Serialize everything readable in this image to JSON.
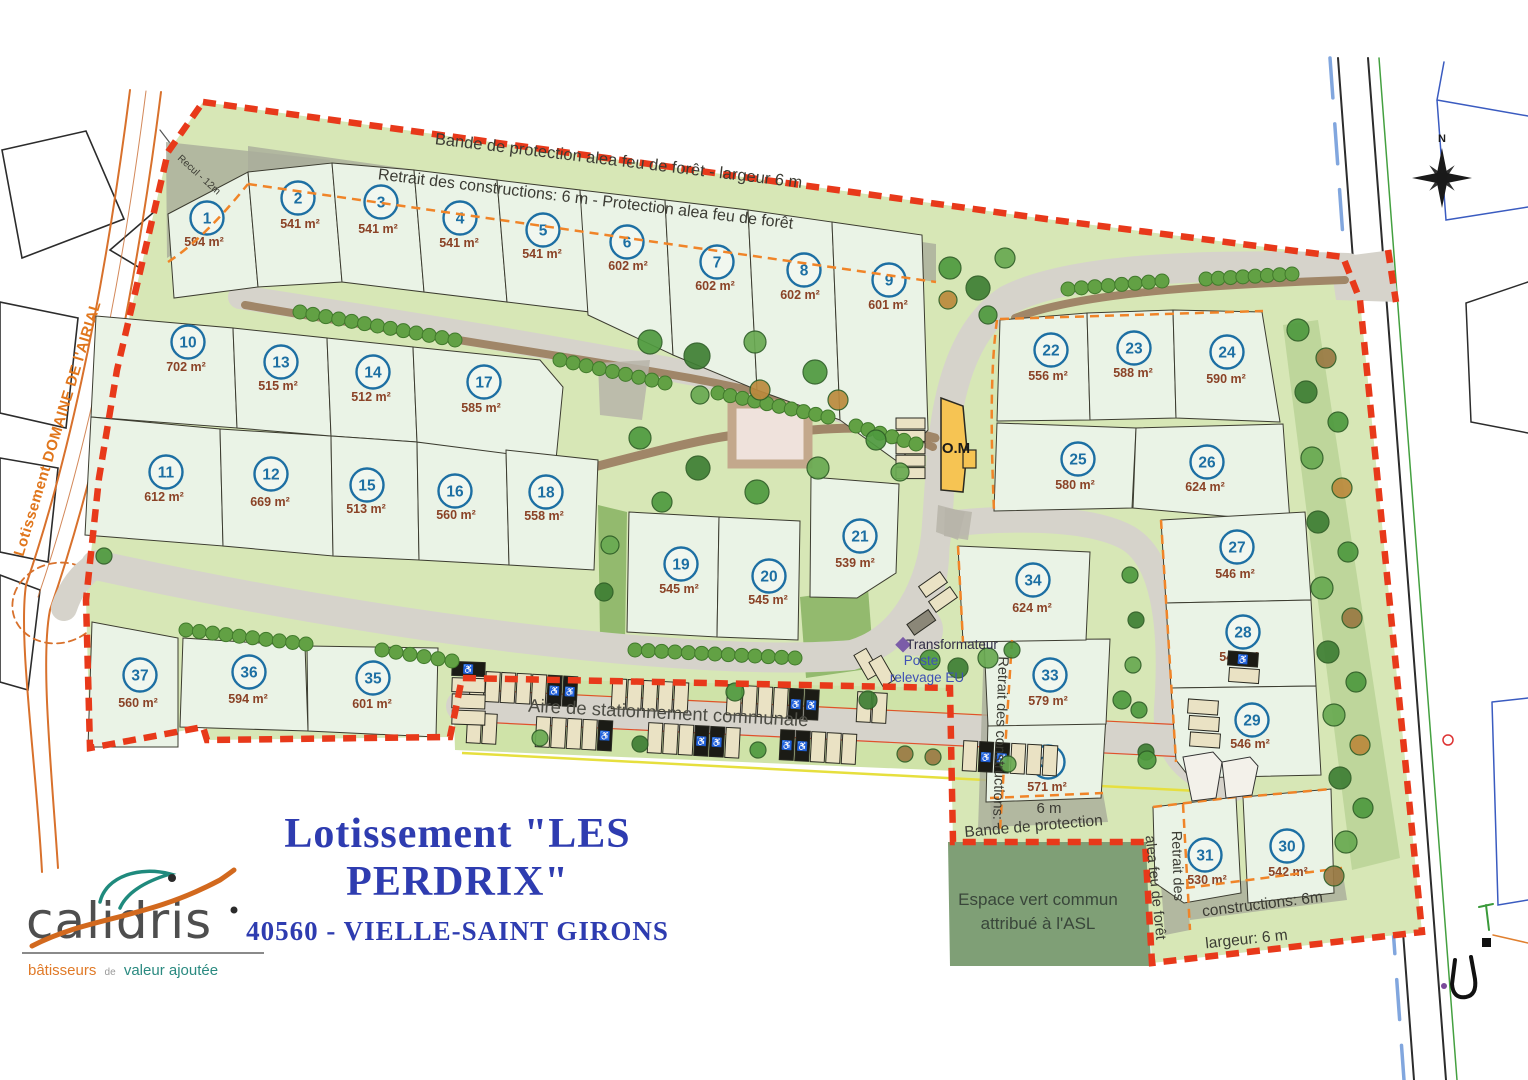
{
  "title": {
    "main": "Lotissement \"LES PERDRIX\"",
    "subtitle": "40560 - VIELLE-SAINT GIRONS"
  },
  "logo": {
    "name": "calidris",
    "tagline_1": "bâtisseurs",
    "tagline_2": "de",
    "tagline_3": "valeur ajoutée"
  },
  "compass": {
    "north": "N"
  },
  "map": {
    "labels": {
      "bande_top": "Bande de protection alea feu de forêt - largeur 6 m",
      "retrait_top": "Retrait des constructions: 6 m - Protection alea feu de forêt",
      "recul": "Recul - 12m",
      "airal": "Lotissement DOMAINE DE l'AIRIAL",
      "om": "O.M",
      "transformateur": "Transformateur",
      "poste_line1": "Poste",
      "poste_line2": "relevage EU",
      "retrait_vertical": "Retrait des constructions:",
      "six_m": "6 m",
      "bande_protection": "Bande de protection",
      "espace_line1": "Espace vert commun",
      "espace_line2": "attribué à l'ASL",
      "alea_vertical": "alea feu de forêt",
      "retrait_des": "Retrait des",
      "constructions_6m": "constructions: 6m",
      "largeur": "largeur: 6 m",
      "parking": "Aire de stationnement communale"
    },
    "lots": [
      {
        "id": "1",
        "area": "594 m²"
      },
      {
        "id": "2",
        "area": "541 m²"
      },
      {
        "id": "3",
        "area": "541 m²"
      },
      {
        "id": "4",
        "area": "541 m²"
      },
      {
        "id": "5",
        "area": "541 m²"
      },
      {
        "id": "6",
        "area": "602 m²"
      },
      {
        "id": "7",
        "area": "602 m²"
      },
      {
        "id": "8",
        "area": "602 m²"
      },
      {
        "id": "9",
        "area": "601 m²"
      },
      {
        "id": "10",
        "area": "702 m²"
      },
      {
        "id": "11",
        "area": "612 m²"
      },
      {
        "id": "12",
        "area": "669 m²"
      },
      {
        "id": "13",
        "area": "515 m²"
      },
      {
        "id": "14",
        "area": "512 m²"
      },
      {
        "id": "15",
        "area": "513 m²"
      },
      {
        "id": "16",
        "area": "560 m²"
      },
      {
        "id": "17",
        "area": "585 m²"
      },
      {
        "id": "18",
        "area": "558 m²"
      },
      {
        "id": "19",
        "area": "545 m²"
      },
      {
        "id": "20",
        "area": "545 m²"
      },
      {
        "id": "21",
        "area": "539 m²"
      },
      {
        "id": "22",
        "area": "556 m²"
      },
      {
        "id": "23",
        "area": "588 m²"
      },
      {
        "id": "24",
        "area": "590 m²"
      },
      {
        "id": "25",
        "area": "580 m²"
      },
      {
        "id": "26",
        "area": "624 m²"
      },
      {
        "id": "27",
        "area": "546 m²"
      },
      {
        "id": "28",
        "area": "546 m²"
      },
      {
        "id": "29",
        "area": "546 m²"
      },
      {
        "id": "30",
        "area": "542 m²"
      },
      {
        "id": "31",
        "area": "530 m²"
      },
      {
        "id": "32",
        "area": "571 m²"
      },
      {
        "id": "33",
        "area": "579 m²"
      },
      {
        "id": "34",
        "area": "624 m²"
      },
      {
        "id": "35",
        "area": "601 m²"
      },
      {
        "id": "36",
        "area": "594 m²"
      },
      {
        "id": "37",
        "area": "560 m²"
      }
    ]
  },
  "colors": {
    "boundary_red": "#e8391a",
    "setback_orange": "#f08428",
    "lot_fill": "#eaf3e6",
    "site_green": "#d7e7b6",
    "espace_vert_green": "#7f9f76",
    "road_gray": "#d6d3cb",
    "lot_number_blue": "#1d6fa3",
    "area_brown": "#8a4226",
    "title_blue": "#2e3cb0",
    "logo_orange": "#e07a28",
    "logo_teal": "#2a8a80"
  }
}
